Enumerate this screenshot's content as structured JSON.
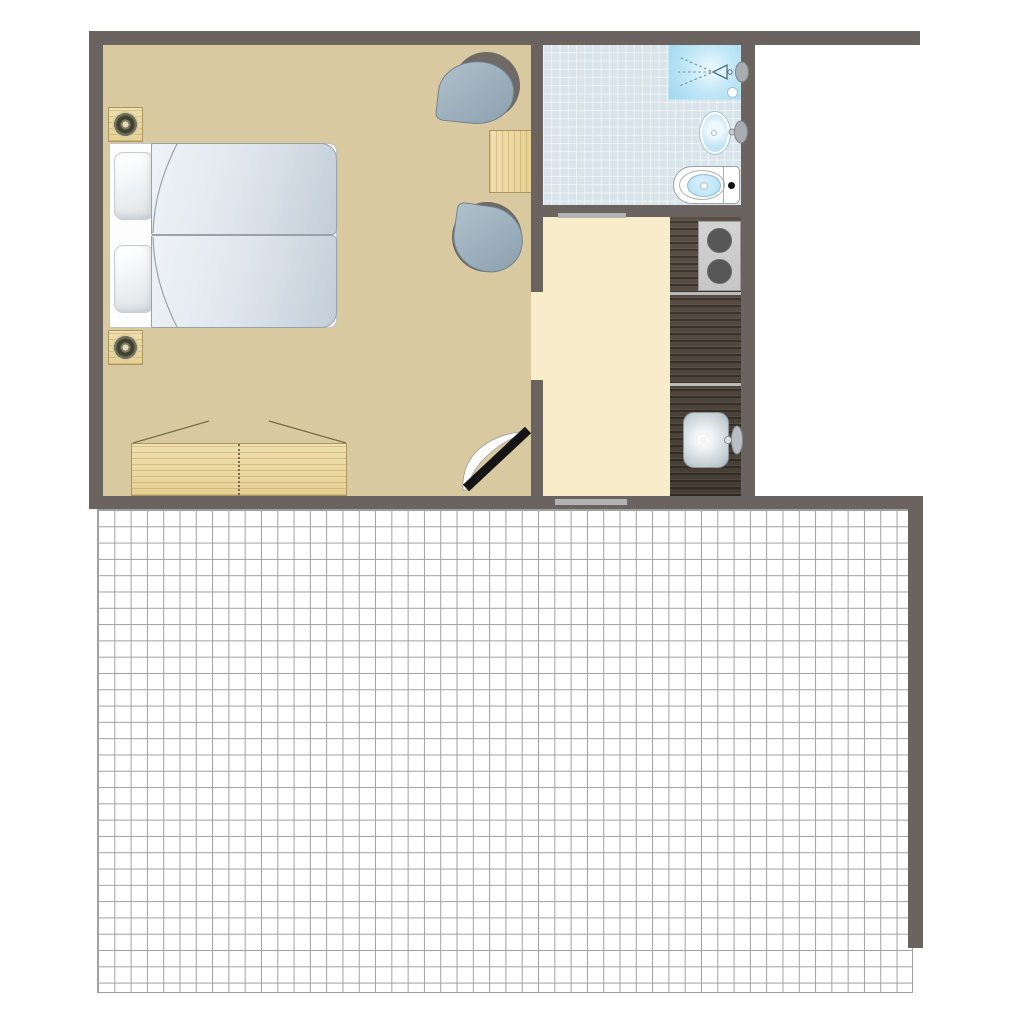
{
  "palette": {
    "wall": "#6a635f",
    "bedroom_floor": "#d8c9a1",
    "kitchen_floor": "#f8ecca",
    "bath_tile": "#d9e5ea",
    "bath_tile_line": "rgba(255,255,255,0.55)",
    "terrace_line": "#a0a0a0",
    "wood_grain": "rgba(171,138,70,0.35)",
    "wood_edge": "#ab9560",
    "counter_streak": "rgba(0,0,0,0.30)",
    "cooktop": "#c6c6c6",
    "burner": "#575757",
    "divider": "#b9b9b9",
    "window_bar": "#b3b3b3",
    "duvet_edge": "#97a2ad",
    "chair_back": "#6f6a65",
    "blue": "#ade0f6",
    "steel_dark": "#aab6bc",
    "lamp_dark": "#41432f",
    "door_leaf": "#151515"
  },
  "floorplan": {
    "rooms": [
      {
        "name": "bedroom",
        "floor_finish": "tan",
        "items": [
          "twin-beds",
          "pillows",
          "duvets",
          "nightstand-with-lamp",
          "nightstand-with-lamp",
          "wardrobe",
          "lounge-chair",
          "lounge-chair",
          "side-table",
          "entry-door"
        ]
      },
      {
        "name": "bathroom",
        "floor_finish": "light-blue-tile",
        "items": [
          "shower",
          "shower-spray-icon",
          "washbasin",
          "toilet",
          "sliding-door"
        ]
      },
      {
        "name": "kitchenette",
        "floor_finish": "cream",
        "items": [
          "counter",
          "cooktop-two-burners",
          "kitchen-sink",
          "window"
        ]
      },
      {
        "name": "terrace",
        "floor_finish": "white-tile-grid",
        "items": []
      }
    ]
  }
}
